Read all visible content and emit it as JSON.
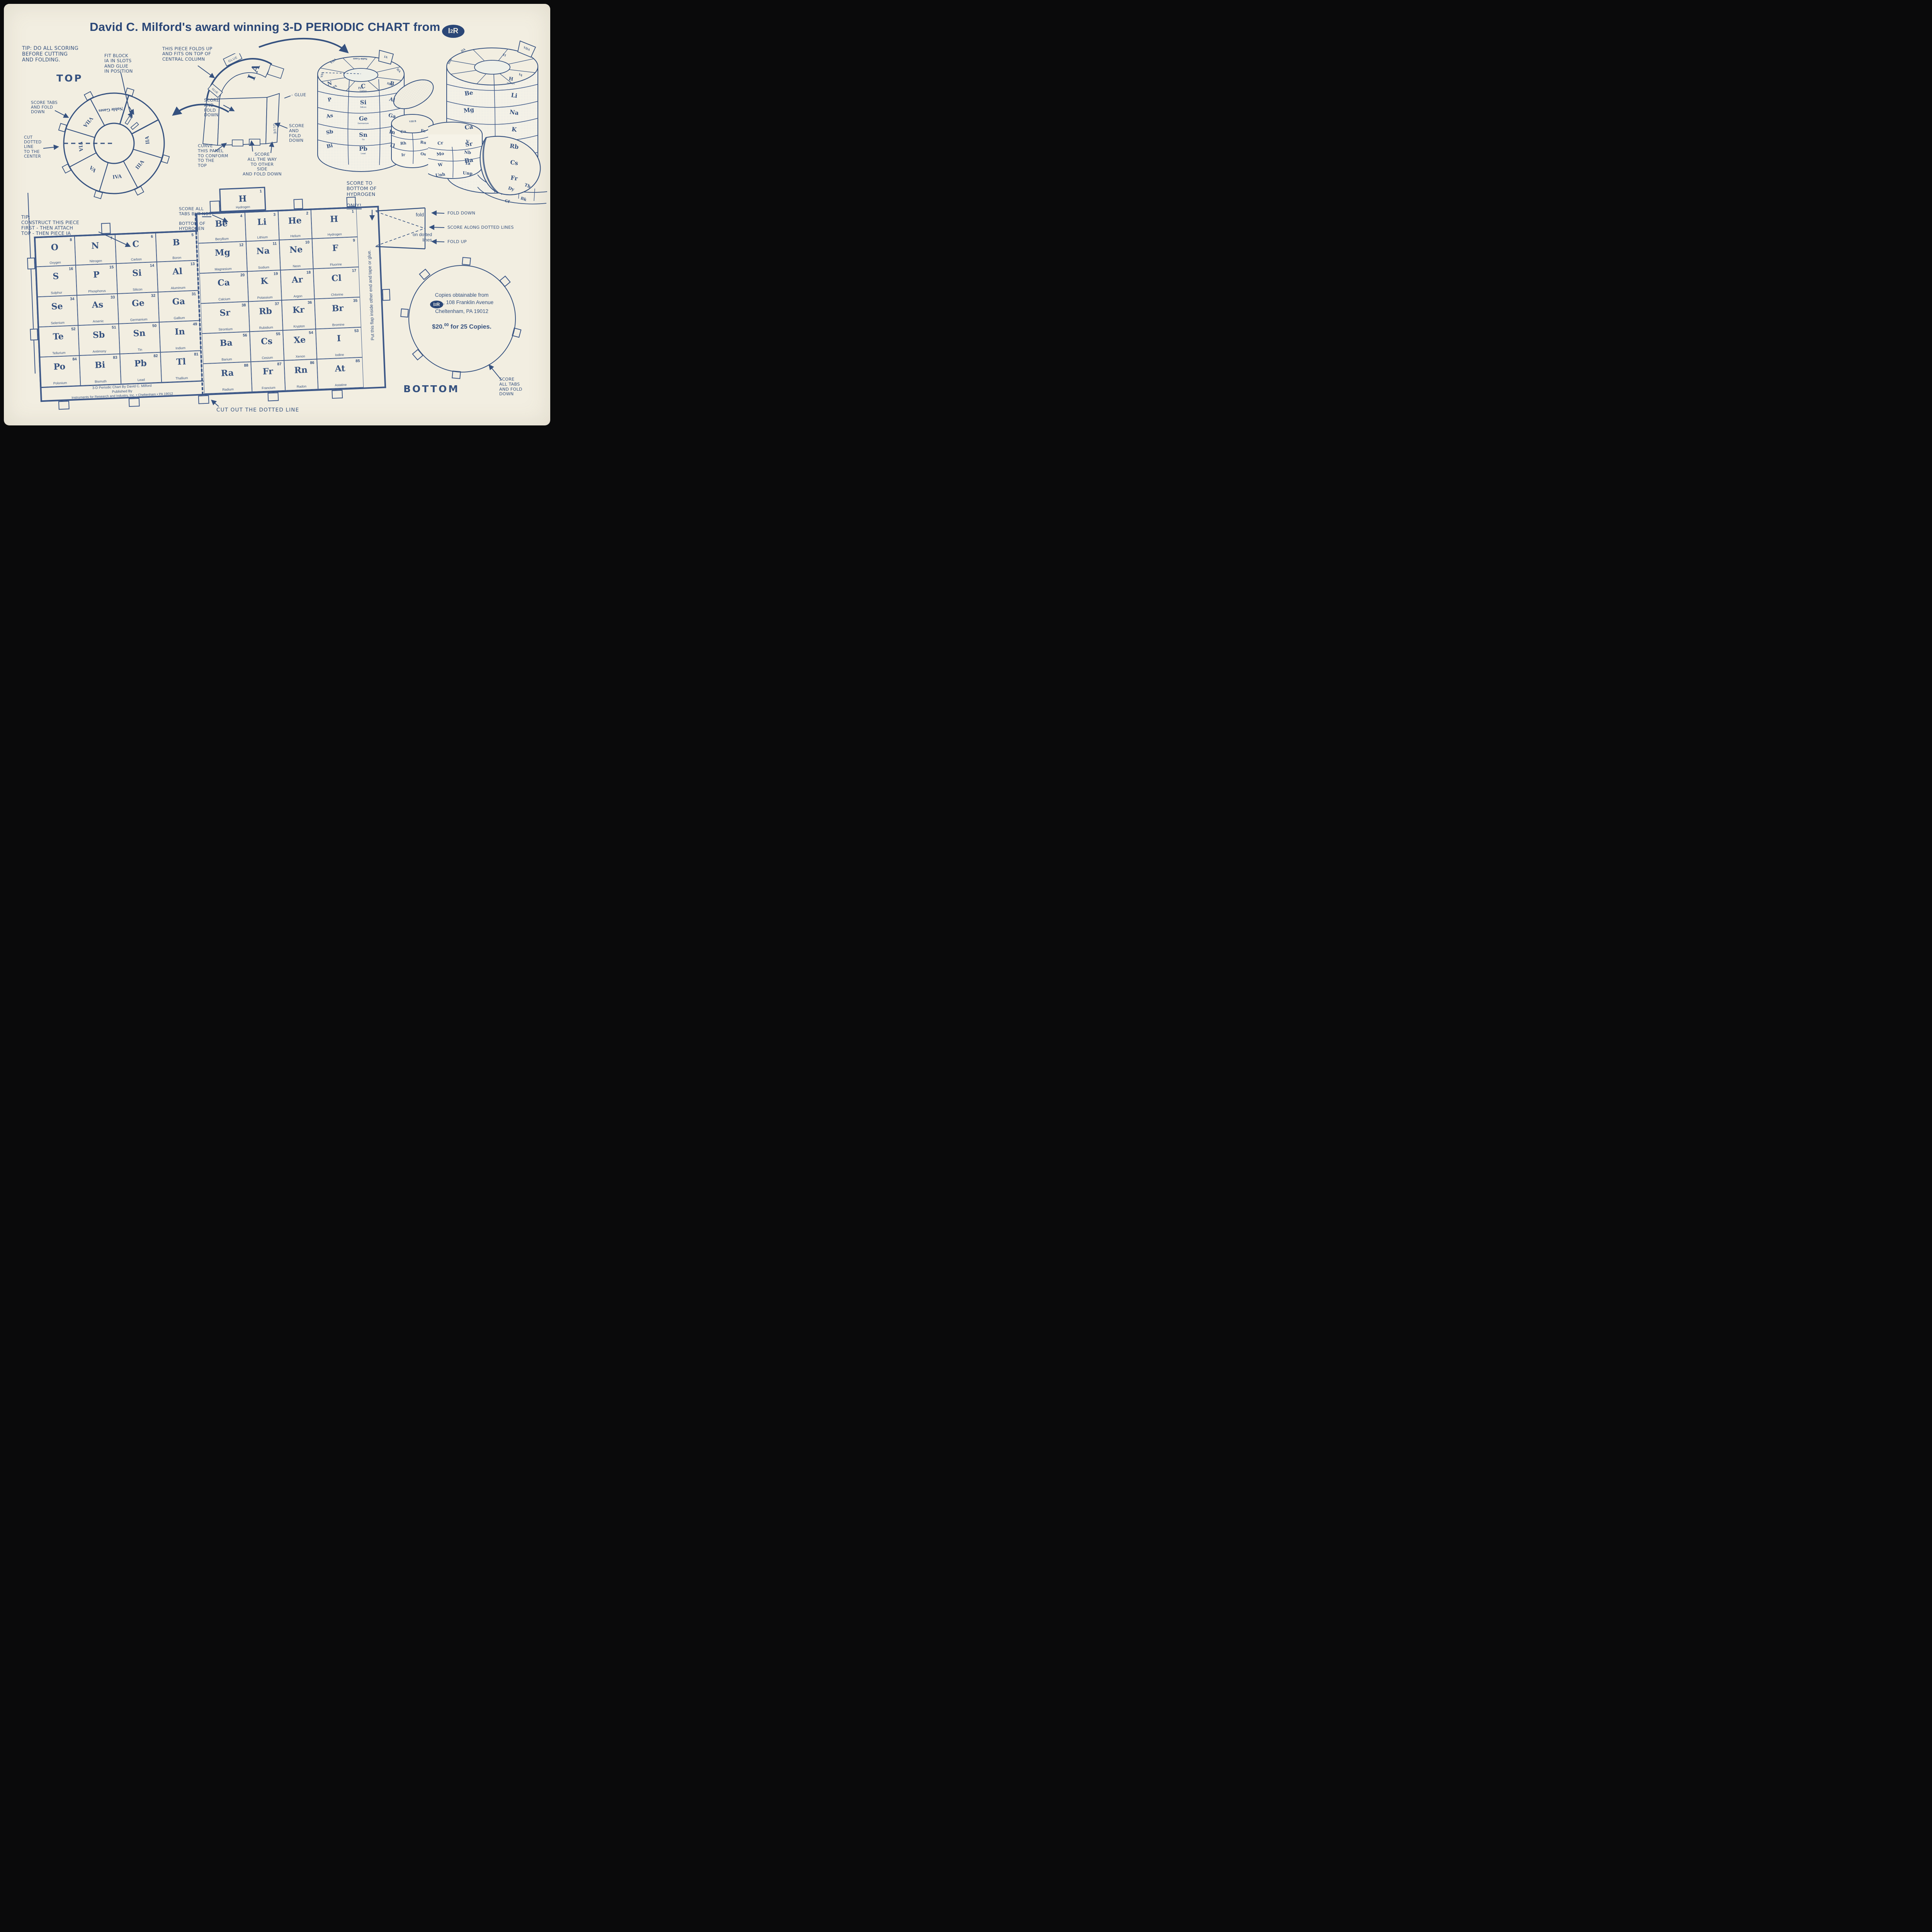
{
  "page": {
    "paper_color": "#f2eee1",
    "ink_color": "#35517f",
    "frame_color": "#0a0a0b"
  },
  "title": {
    "text": "David C. Milford's award winning 3-D PERIODIC CHART from",
    "logo_i": "I",
    "logo_2": "2",
    "logo_r": "R"
  },
  "annotations": {
    "tip_scoring": "TIP: DO ALL SCORING\nBEFORE CUTTING\nAND FOLDING.",
    "top_label": "TOP",
    "score_tabs": "SCORE TABS\nAND FOLD\nDOWN",
    "cut_dotted": "CUT\nDOTTED\nLINE\nTO THE\nCENTER",
    "fit_block": "FIT BLOCK\nIA IN SLOTS\nAND GLUE\nIN POSITION",
    "cut_out_slots": "CUT OUT\nSLOTS",
    "piece_folds": "THIS PIECE FOLDS UP\nAND FITS ON TOP OF\nCENTRAL COLUMN",
    "score_fold_left": "SCORE\nAND\nFOLD\nDOWN",
    "glue_dash": "- GLUE",
    "score_fold_right": "SCORE\nAND\nFOLD\nDOWN",
    "curve_panel": "CURVE\nTHIS PANEL\nTO CONFORM\nTO THE\nTOP",
    "score_all_way": "SCORE\nALL THE WAY\nTO OTHER\nSIDE\nAND FOLD DOWN",
    "score_hydrogen_a": "SCORE TO\nBOTTOM OF\nHYDROGEN",
    "score_hydrogen_b": "ONLY!",
    "tip_construct": "TIP:\nCONSTRUCT THIS PIECE\nFIRST - THEN ATTACH\nTOP - THEN PIECE IA",
    "score_not_a": "SCORE ALL\nTABS BUT ",
    "score_not_b": "NOT",
    "score_not_c": "BOTTOM OF\nHYDROGEN",
    "fold": "fold",
    "on_dotted": "on dotted\nlines",
    "fold_down": "FOLD DOWN",
    "score_along": "SCORE ALONG DOTTED LINES",
    "fold_up": "FOLD UP",
    "cut_out_line": "CUT OUT THE DOTTED LINE",
    "flap": "Put this flap inside other end and tape or glue.",
    "bottom_label": "BOTTOM",
    "score_all_tabs": "SCORE\nALL TABS\nAND FOLD\nDOWN",
    "glue": "GLUE",
    "ia_piece": "I A"
  },
  "publisher": {
    "line1": "3-D Periodic Chart By David C. Milford",
    "line2": "Published By",
    "line3": "Instruments for Research and Industry, Inc. • Cheltenham • PA 19012"
  },
  "bottom_circle": {
    "line1": "Copies obtainable from",
    "line2": ", 108 Franklin Avenue",
    "line3": "Cheltenham, PA 19012",
    "price_main": "$20.",
    "price_sup": "00",
    "price_rest": " for 25 Copies."
  },
  "ring": {
    "segments": [
      "IIA",
      "IIIA",
      "IVA",
      "VA",
      "VIA",
      "VIIA",
      "Noble Gases"
    ]
  },
  "table": {
    "top_cell": {
      "s": "H",
      "n": "1",
      "name": "Hydrogen"
    },
    "left_block": [
      [
        {
          "s": "O",
          "n": "8",
          "name": "Oxygen"
        },
        {
          "s": "S",
          "n": "16",
          "name": "Sulphur"
        },
        {
          "s": "Se",
          "n": "34",
          "name": "Selenium"
        },
        {
          "s": "Te",
          "n": "52",
          "name": "Tellurium"
        },
        {
          "s": "Po",
          "n": "84",
          "name": "Polonium"
        }
      ],
      [
        {
          "s": "N",
          "n": "7",
          "name": "Nitrogen"
        },
        {
          "s": "P",
          "n": "15",
          "name": "Phosphorus"
        },
        {
          "s": "As",
          "n": "33",
          "name": "Arsenic"
        },
        {
          "s": "Sb",
          "n": "51",
          "name": "Antimony"
        },
        {
          "s": "Bi",
          "n": "83",
          "name": "Bismuth"
        }
      ],
      [
        {
          "s": "C",
          "n": "6",
          "name": "Carbon"
        },
        {
          "s": "Si",
          "n": "14",
          "name": "Silicon"
        },
        {
          "s": "Ge",
          "n": "32",
          "name": "Germanium"
        },
        {
          "s": "Sn",
          "n": "50",
          "name": "Tin"
        },
        {
          "s": "Pb",
          "n": "82",
          "name": "Lead"
        }
      ],
      [
        {
          "s": "B",
          "n": "5",
          "name": "Boron"
        },
        {
          "s": "Al",
          "n": "13",
          "name": "Aluminum"
        },
        {
          "s": "Ga",
          "n": "31",
          "name": "Gallium"
        },
        {
          "s": "In",
          "n": "49",
          "name": "Indium"
        },
        {
          "s": "Tl",
          "n": "81",
          "name": "Thallium"
        }
      ]
    ],
    "main_block": [
      [
        {
          "s": "Be",
          "n": "4",
          "name": "Beryllium"
        },
        {
          "s": "Mg",
          "n": "12",
          "name": "Magnesium"
        },
        {
          "s": "Ca",
          "n": "20",
          "name": "Calcium"
        },
        {
          "s": "Sr",
          "n": "38",
          "name": "Strontium"
        },
        {
          "s": "Ba",
          "n": "56",
          "name": "Barium"
        },
        {
          "s": "Ra",
          "n": "88",
          "name": "Radium"
        }
      ],
      [
        {
          "s": "Li",
          "n": "3",
          "name": "Lithium"
        },
        {
          "s": "Na",
          "n": "11",
          "name": "Sodium"
        },
        {
          "s": "K",
          "n": "19",
          "name": "Potassium"
        },
        {
          "s": "Rb",
          "n": "37",
          "name": "Rubidium"
        },
        {
          "s": "Cs",
          "n": "55",
          "name": "Cesium"
        },
        {
          "s": "Fr",
          "n": "87",
          "name": "Francium"
        }
      ],
      [
        {
          "s": "He",
          "n": "2",
          "name": "Helium"
        },
        {
          "s": "Ne",
          "n": "10",
          "name": "Neon"
        },
        {
          "s": "Ar",
          "n": "18",
          "name": "Argon"
        },
        {
          "s": "Kr",
          "n": "36",
          "name": "Krypton"
        },
        {
          "s": "Xe",
          "n": "54",
          "name": "Xenon"
        },
        {
          "s": "Rn",
          "n": "86",
          "name": "Radon"
        }
      ],
      [
        {
          "s": "H",
          "n": "1",
          "name": "Hydrogen"
        },
        {
          "s": "F",
          "n": "9",
          "name": "Fluorine"
        },
        {
          "s": "Cl",
          "n": "17",
          "name": "Chlorine"
        },
        {
          "s": "Br",
          "n": "35",
          "name": "Bromine"
        },
        {
          "s": "I",
          "n": "53",
          "name": "Iodine"
        },
        {
          "s": "At",
          "n": "85",
          "name": "Astatine"
        }
      ]
    ]
  },
  "models": {
    "left": {
      "ring": [
        "VIA",
        "VIIA",
        "Noble Gases",
        "IA",
        "IIA",
        "IIIA",
        "IVA",
        "VA"
      ],
      "col_left": [
        "N",
        "P",
        "As",
        "Sb",
        "Bi"
      ],
      "col_mid": [
        "C",
        "Si",
        "Ge",
        "Sn",
        "Pb"
      ],
      "col_mid_names": [
        "Carbon",
        "Silicon",
        "Germanium",
        "Tin",
        "Lead"
      ],
      "col_right": [
        "B",
        "Al",
        "Ga",
        "In",
        "Tl"
      ],
      "side_top": "VIII B",
      "side_left": [
        "Co",
        "Rh",
        "Ir"
      ],
      "side_right": [
        "Fe",
        "Ru",
        "Os"
      ]
    },
    "right": {
      "ring": [
        "IIA",
        "IIIA",
        "IA",
        "VA",
        "VIIA"
      ],
      "col_left": [
        "Be",
        "Mg",
        "Ca",
        "Sr",
        "Ba"
      ],
      "col_right": [
        "H",
        "Li",
        "Na",
        "K",
        "Rb",
        "Cs",
        "Fr"
      ],
      "col_right_name": "Hydrogen",
      "side_left": [
        "Cr",
        "Mo",
        "W",
        "Unh"
      ],
      "side_right": [
        "V",
        "Nb",
        "Ta",
        "Unp"
      ],
      "lanth": [
        "Dy",
        "Tb",
        "Cf",
        "Bk"
      ]
    }
  }
}
